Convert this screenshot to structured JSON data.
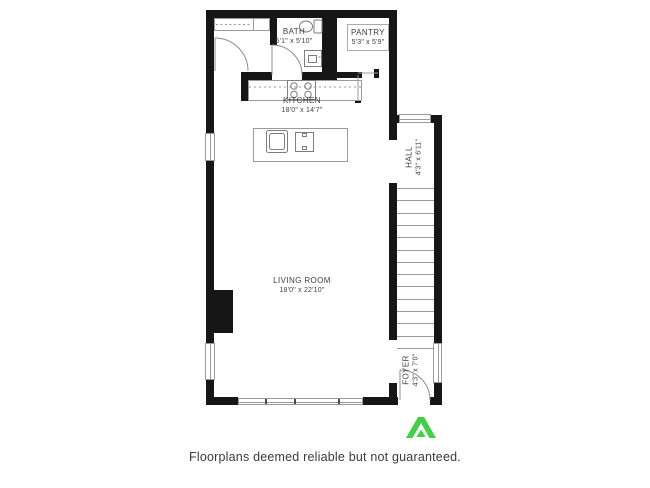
{
  "floorplan": {
    "rooms": {
      "bath": {
        "name": "BATH",
        "dims": "5'1\" x 5'10\""
      },
      "pantry": {
        "name": "PANTRY",
        "dims": "5'3\" x 5'9\""
      },
      "kitchen": {
        "name": "KITCHEN",
        "dims": "18'0\" x 14'7\""
      },
      "hall": {
        "name": "HALL",
        "dims": "4'3\" x 6'11\""
      },
      "living_room": {
        "name": "LIVING ROOM",
        "dims": "18'0\" x 22'10\""
      },
      "foyer": {
        "name": "FOYER",
        "dims": "4'3\" x 7'0\""
      }
    },
    "stairs": {
      "treads": 14
    },
    "fixtures": [
      "toilet",
      "bath-sink",
      "stove",
      "kitchen-counter",
      "island",
      "island-sink",
      "fireplace",
      "closet-rod",
      "pantry-shelves"
    ],
    "colors": {
      "wall": "#161616",
      "thin_line": "#8c8c8c",
      "label_text": "#3f3f3f"
    }
  },
  "footer": {
    "disclaimer": "Floorplans deemed reliable but not guaranteed.",
    "logo_icon": "green-chevron-logo",
    "logo_color": "#3fd143"
  }
}
